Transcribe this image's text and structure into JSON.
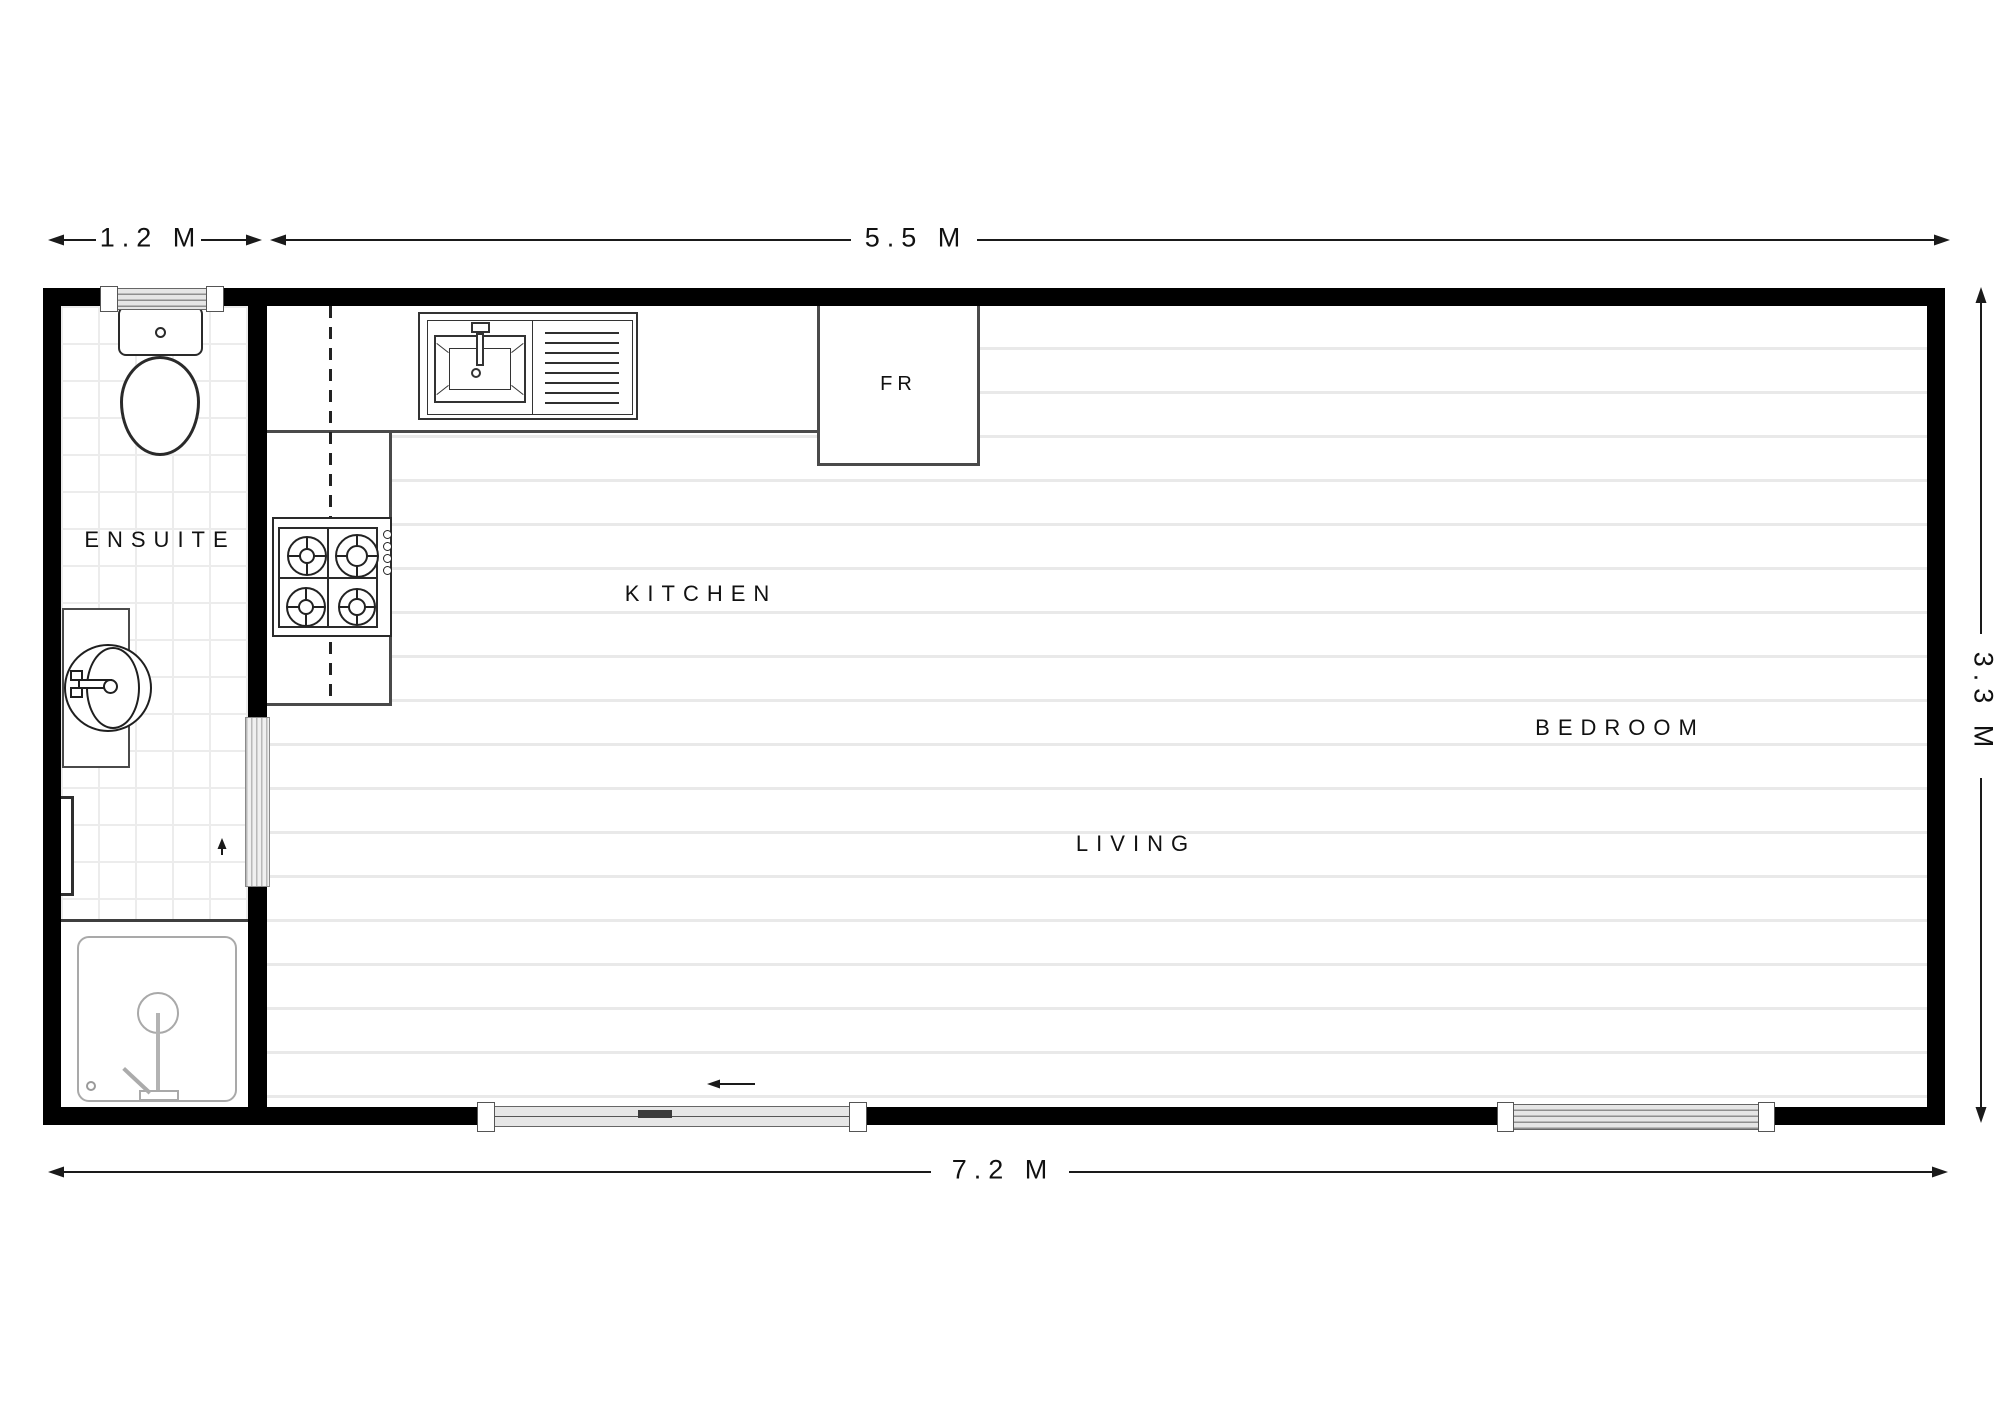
{
  "title": "Studio floor plan",
  "rooms": {
    "ensuite": "ENSUITE",
    "kitchen": "KITCHEN",
    "living": "LIVING",
    "bedroom": "BEDROOM",
    "fridge": "FR"
  },
  "dimensions": {
    "ensuite_width": "1.2 M",
    "main_width": "5.5 M",
    "depth": "3.3 M",
    "total_width": "7.2 M"
  },
  "colors": {
    "wall": "#000000",
    "ink": "#1a1a1a",
    "counter_edge": "#4a4a4a",
    "floor_line": "#e9e9e9",
    "tile_line": "#ececec",
    "shower_line": "#a9a9a9"
  }
}
